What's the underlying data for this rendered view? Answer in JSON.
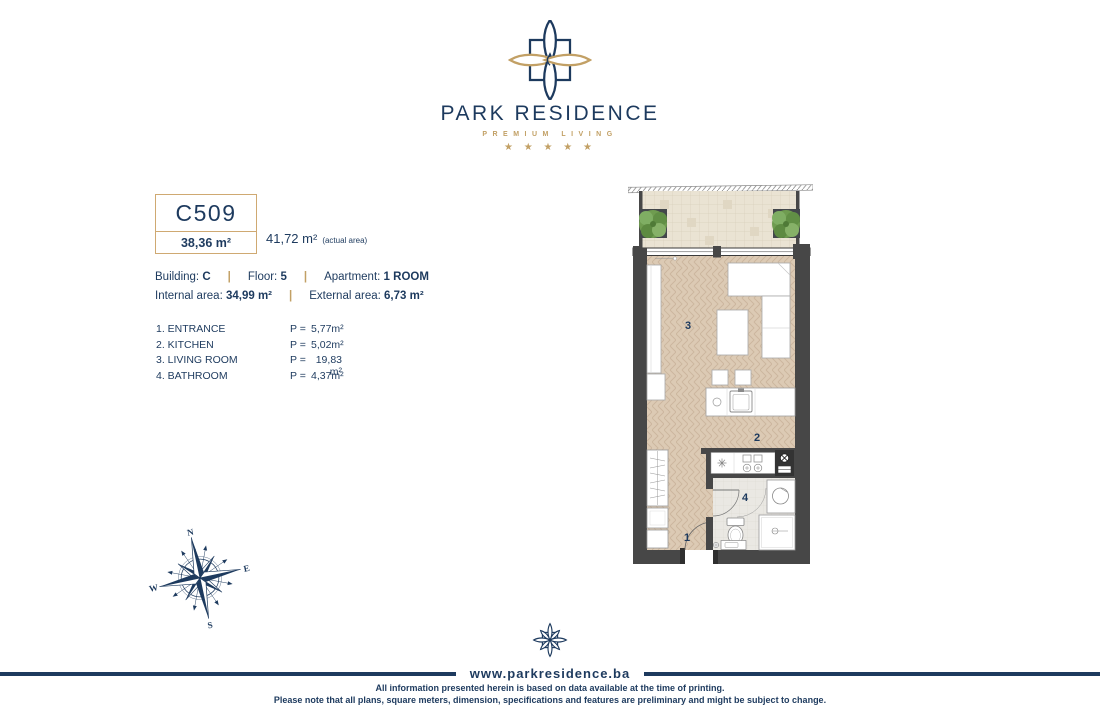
{
  "colors": {
    "navy": "#1d3a5e",
    "gold": "#c2a065",
    "wall": "#474747"
  },
  "header": {
    "brand_name": "PARK RESIDENCE",
    "tagline": "PREMIUM LIVING",
    "stars": "★ ★ ★ ★ ★"
  },
  "unit": {
    "code": "C509",
    "area": "38,36 m²",
    "actual_area": "41,72 m²",
    "actual_area_note": "(actual area)"
  },
  "details": {
    "building_label": "Building:",
    "building_value": "C",
    "floor_label": "Floor:",
    "floor_value": "5",
    "apartment_label": "Apartment:",
    "apartment_value": "1 ROOM",
    "internal_label": "Internal area:",
    "internal_value": "34,99 m²",
    "external_label": "External area:",
    "external_value": "6,73 m²",
    "separator": "|"
  },
  "rooms": [
    {
      "name": "1. ENTRANCE",
      "p": "P =",
      "area": "5,77m²"
    },
    {
      "name": "2. KITCHEN",
      "p": "P =",
      "area": "5,02m²"
    },
    {
      "name": "3. LIVING ROOM",
      "p": "P =",
      "area": "19,83 m²"
    },
    {
      "name": "4. BATHROOM",
      "p": "P =",
      "area": "4,37m²"
    }
  ],
  "plan": {
    "labels": {
      "entrance": "1",
      "kitchen": "2",
      "living": "3",
      "bathroom": "4"
    }
  },
  "compass": {
    "n": "N",
    "e": "E",
    "s": "S",
    "w": "W"
  },
  "footer": {
    "website": "www.parkresidence.ba",
    "disclaimer1": "All information presented herein is based on data available at the time of printing.",
    "disclaimer2": "Please note that all plans, square meters, dimension, specifications and features are preliminary and might be subject to change."
  }
}
